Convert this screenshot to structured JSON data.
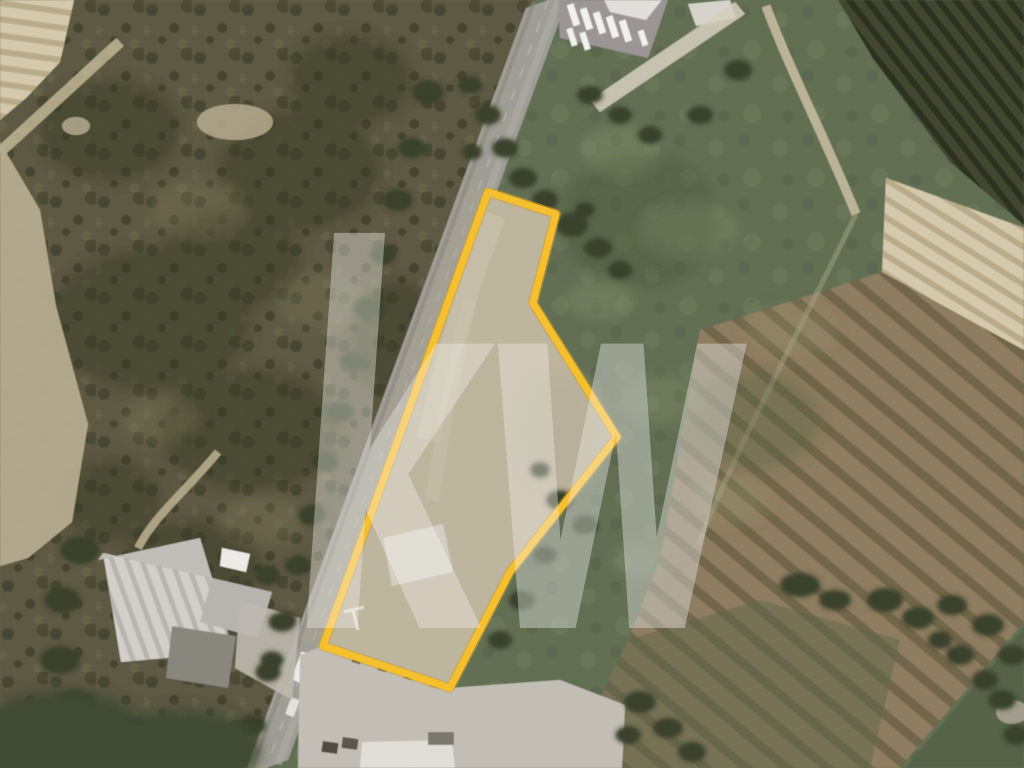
{
  "scene": {
    "description": "Aerial satellite photo of a rural land parcel outlined in yellow beside a two-lane road, real-estate listing style",
    "watermark": {
      "text": "kw",
      "color": "#ffffff",
      "opacity": "0.30"
    },
    "parcel": {
      "points": "488,192 556,214 533,303 617,437 510,572 450,688 323,646",
      "fill": "#b3a890",
      "outline_color": "#f4b428",
      "outline_underglow": "#c9901a",
      "outline_width": "7"
    },
    "road": {
      "points": "526,8 570,-8 288,760 244,776",
      "surface_color": "#8d8b85"
    },
    "terrain_colors": {
      "grass": "#55604a",
      "scrubland": "#514d3b",
      "dark_orchard": "#3a3c2c",
      "cream_field": "#cdc0a0",
      "brown_orchard": "#7b6c54",
      "warehouse_roof": "#c9c7c1",
      "yard": "#b7b3aa"
    }
  }
}
